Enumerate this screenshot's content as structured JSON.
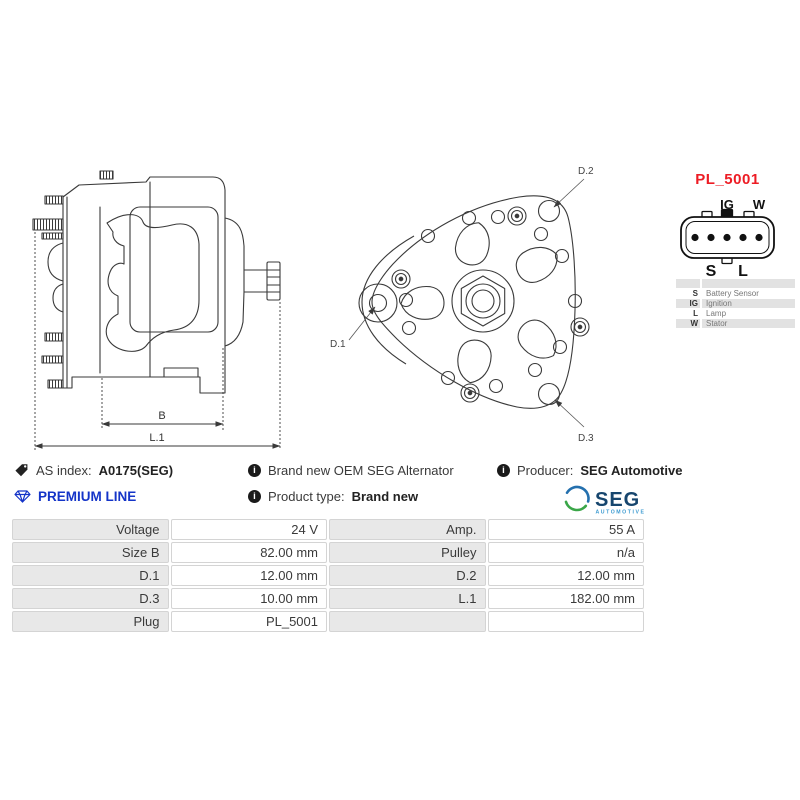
{
  "colors": {
    "plug_title_red": "#ed1c24",
    "premium_blue": "#1434c8",
    "seg_navy": "#17466e",
    "seg_light_blue": "#3d9bd1",
    "seg_green": "#3aa648",
    "table_label_gray": "#e8e8e8",
    "drawing_line": "#3a3a3a"
  },
  "side_view": {
    "dim_b": "B",
    "dim_l1": "L.1"
  },
  "front_view": {
    "d1": "D.1",
    "d2": "D.2",
    "d3": "D.3"
  },
  "plug": {
    "title": "PL_5001",
    "pin_labels_top": [
      "IG",
      "W"
    ],
    "pin_labels_bottom": [
      "S",
      "L"
    ],
    "legend": [
      {
        "key": "S",
        "desc": "Battery Sensor"
      },
      {
        "key": "IG",
        "desc": "Ignition"
      },
      {
        "key": "L",
        "desc": "Lamp"
      },
      {
        "key": "W",
        "desc": "Stator"
      }
    ]
  },
  "info": {
    "as_index_label": "AS index:",
    "as_index_value": "A0175(SEG)",
    "premium_line": "PREMIUM LINE",
    "brand_new_text": "Brand new OEM SEG Alternator",
    "product_type_label": "Product type:",
    "product_type_value": "Brand new",
    "producer_label": "Producer:",
    "producer_value": "SEG Automotive",
    "logo_text": "SEG",
    "logo_subtext": "AUTOMOTIVE",
    "info_icon_glyph": "i"
  },
  "specs": {
    "rows": [
      {
        "label1": "Voltage",
        "value1": "24 V",
        "label2": "Amp.",
        "value2": "55 A"
      },
      {
        "label1": "Size B",
        "value1": "82.00 mm",
        "label2": "Pulley",
        "value2": "n/a"
      },
      {
        "label1": "D.1",
        "value1": "12.00 mm",
        "label2": "D.2",
        "value2": "12.00 mm"
      },
      {
        "label1": "D.3",
        "value1": "10.00 mm",
        "label2": "L.1",
        "value2": "182.00 mm"
      },
      {
        "label1": "Plug",
        "value1": "PL_5001",
        "label2": "",
        "value2": ""
      }
    ]
  }
}
